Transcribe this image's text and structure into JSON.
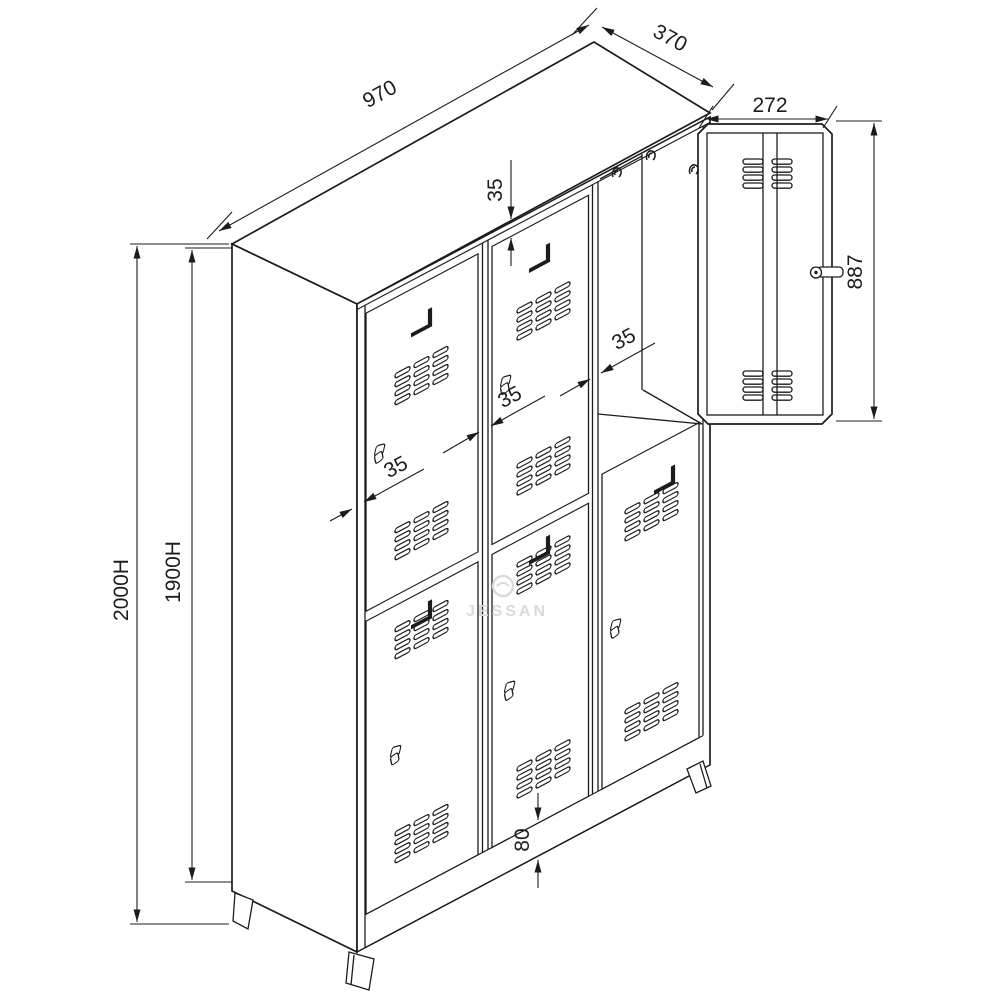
{
  "drawing": {
    "type": "technical-dimension-drawing",
    "subject": "six-door metal locker cabinet, isometric view with detached door detail",
    "labels": {
      "top_width": "970",
      "top_depth": "370",
      "open_door_width": "272",
      "open_door_height": "887",
      "overall_height": "2000H",
      "body_height": "1900H",
      "gap_top": "35",
      "gap_right": "35",
      "gap_center": "35",
      "gap_left": "35",
      "plinth_height": "80",
      "watermark": "JESSAN"
    },
    "colors": {
      "line": "#1c1c1c",
      "background": "#ffffff",
      "watermark": "#dadada"
    }
  }
}
